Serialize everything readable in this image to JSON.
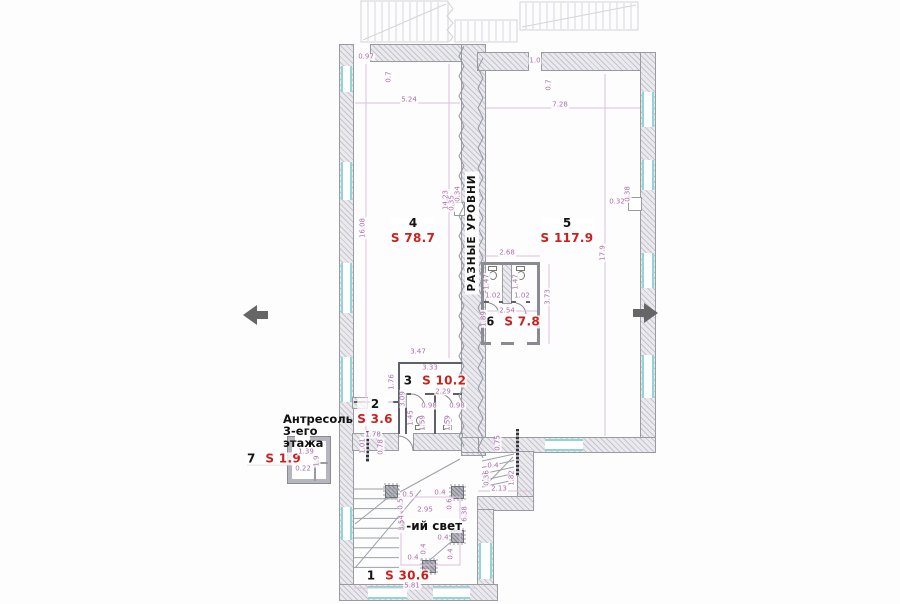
{
  "labels": {
    "divider": "РАЗНЫЕ УРОВНИ",
    "mezzanine_line1": "Антресоль",
    "mezzanine_line2": "3-его",
    "mezzanine_line3": "этажа",
    "void": "3-ий свет"
  },
  "colors": {
    "area_red": "#c9211e",
    "dimension_purple": "#ad6bad",
    "window_teal": "#8fd6d6",
    "wall_hatch_gray": "#c4c4cc",
    "arrow_gray": "#666666"
  },
  "rooms": [
    {
      "number": "4",
      "area": "S 78.7",
      "x": 413,
      "y": 231,
      "layout": "stacked"
    },
    {
      "number": "5",
      "area": "S 117.9",
      "x": 567,
      "y": 231,
      "layout": "stacked"
    },
    {
      "number": "6",
      "area": "S 7.8",
      "x": 513,
      "y": 322,
      "layout": "inline"
    },
    {
      "number": "3",
      "area": "S 10.2",
      "x": 435,
      "y": 381,
      "layout": "inline"
    },
    {
      "number": "2",
      "area": "S 3.6",
      "x": 375,
      "y": 412,
      "layout": "stacked"
    },
    {
      "number": "7",
      "area": "S 1.9",
      "x": 274,
      "y": 459,
      "layout": "inline"
    },
    {
      "number": "1",
      "area": "S 30.6",
      "x": 398,
      "y": 576,
      "layout": "inline"
    }
  ],
  "dimensions": [
    {
      "t": "0.97",
      "x": 366,
      "y": 57
    },
    {
      "t": "0.7",
      "x": 389,
      "y": 77,
      "r": 1
    },
    {
      "t": "5.24",
      "x": 409,
      "y": 100
    },
    {
      "t": "1.0",
      "x": 535,
      "y": 61
    },
    {
      "t": "0.7",
      "x": 549,
      "y": 85,
      "r": 1
    },
    {
      "t": "7.28",
      "x": 560,
      "y": 105
    },
    {
      "t": "16.08",
      "x": 363,
      "y": 228,
      "r": 1
    },
    {
      "t": "14.23",
      "x": 446,
      "y": 200,
      "r": 1
    },
    {
      "t": "0.35",
      "x": 452,
      "y": 203,
      "r": 1
    },
    {
      "t": "0.34",
      "x": 458,
      "y": 194,
      "r": 1
    },
    {
      "t": "17.9",
      "x": 603,
      "y": 253,
      "r": 1
    },
    {
      "t": "0.32",
      "x": 617,
      "y": 202
    },
    {
      "t": "0.38",
      "x": 628,
      "y": 194,
      "r": 1
    },
    {
      "t": "2.68",
      "x": 507,
      "y": 253
    },
    {
      "t": "1.47",
      "x": 487,
      "y": 282,
      "r": 1
    },
    {
      "t": "1.47",
      "x": 516,
      "y": 282,
      "r": 1
    },
    {
      "t": "1.02",
      "x": 493,
      "y": 296
    },
    {
      "t": "1.02",
      "x": 522,
      "y": 296
    },
    {
      "t": "2.54",
      "x": 507,
      "y": 311
    },
    {
      "t": "1.89",
      "x": 484,
      "y": 319,
      "r": 1
    },
    {
      "t": "3.73",
      "x": 548,
      "y": 297,
      "r": 1
    },
    {
      "t": "3.47",
      "x": 418,
      "y": 352
    },
    {
      "t": "3.33",
      "x": 430,
      "y": 368
    },
    {
      "t": "1.76",
      "x": 392,
      "y": 382,
      "r": 1
    },
    {
      "t": "3.09",
      "x": 403,
      "y": 399,
      "r": 1
    },
    {
      "t": "1.45",
      "x": 411,
      "y": 418,
      "r": 1
    },
    {
      "t": "2.29",
      "x": 443,
      "y": 392
    },
    {
      "t": "0.98",
      "x": 429,
      "y": 406
    },
    {
      "t": "0.98",
      "x": 457,
      "y": 406
    },
    {
      "t": "1.59",
      "x": 423,
      "y": 423,
      "r": 1
    },
    {
      "t": "1.59",
      "x": 448,
      "y": 423,
      "r": 1
    },
    {
      "t": "1.78",
      "x": 373,
      "y": 435
    },
    {
      "t": "1.01",
      "x": 363,
      "y": 446,
      "r": 1
    },
    {
      "t": "0.78",
      "x": 381,
      "y": 447,
      "r": 1
    },
    {
      "t": "1.39",
      "x": 306,
      "y": 452
    },
    {
      "t": "1.9",
      "x": 317,
      "y": 461,
      "r": 1
    },
    {
      "t": "0.22",
      "x": 303,
      "y": 469
    },
    {
      "t": "0.75",
      "x": 498,
      "y": 443,
      "r": 1
    },
    {
      "t": "0.4",
      "x": 493,
      "y": 466
    },
    {
      "t": "0.36",
      "x": 487,
      "y": 478,
      "r": 1
    },
    {
      "t": "1.82",
      "x": 512,
      "y": 478,
      "r": 1
    },
    {
      "t": "2.13",
      "x": 499,
      "y": 489
    },
    {
      "t": "0.5",
      "x": 408,
      "y": 495
    },
    {
      "t": "0.4",
      "x": 440,
      "y": 493
    },
    {
      "t": "0.5",
      "x": 401,
      "y": 504,
      "r": 1
    },
    {
      "t": "0.6",
      "x": 450,
      "y": 504,
      "r": 1
    },
    {
      "t": "2.95",
      "x": 425,
      "y": 510
    },
    {
      "t": "3.54",
      "x": 402,
      "y": 523,
      "r": 1
    },
    {
      "t": "6.38",
      "x": 465,
      "y": 514,
      "r": 1
    },
    {
      "t": "0.4",
      "x": 443,
      "y": 538
    },
    {
      "t": "0.4",
      "x": 424,
      "y": 549,
      "r": 1
    },
    {
      "t": "0.4",
      "x": 451,
      "y": 554,
      "r": 1
    },
    {
      "t": "0.4",
      "x": 413,
      "y": 558
    },
    {
      "t": "5.81",
      "x": 412,
      "y": 586
    }
  ]
}
